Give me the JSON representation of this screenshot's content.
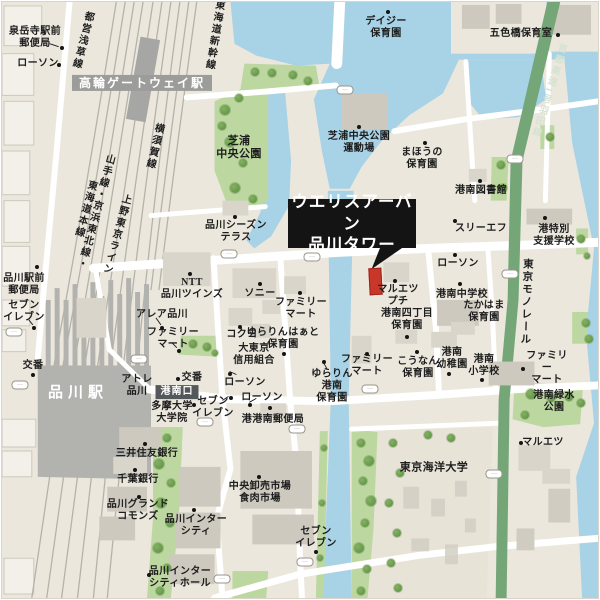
{
  "map": {
    "callout": {
      "line1": "ウエリスアーバン",
      "line2": "品川タワー"
    },
    "colors": {
      "land": "#ebe7dd",
      "water": "#a8d2e6",
      "park": "#bcd79f",
      "tree": "#6fa150",
      "road": "#ffffff",
      "rail": "#b5b2aa",
      "station": "#b2b2af",
      "expressway": "#74a678",
      "building": "#d9d5cb",
      "label": "#1d1d1d",
      "callout_bg": "#141414",
      "highlight_building": "#c8372a",
      "station_badge": "#9c9c9a",
      "exit_badge": "#55585a"
    },
    "labels": [
      {
        "id": "sengakuji-post",
        "text": "泉岳寺駅前\n郵便局",
        "x": 33,
        "y": 36
      },
      {
        "id": "lawson-nw",
        "text": "ローソン",
        "x": 36,
        "y": 62
      },
      {
        "id": "toei-asakusa-line",
        "text": "都営浅草線",
        "x": 79,
        "y": 38,
        "cls": "vert",
        "rotate": 14
      },
      {
        "id": "takanawa-gateway-sta",
        "text": "高輪ゲートウェイ駅",
        "x": 140,
        "y": 81,
        "cls": "badge-gray",
        "size": 12
      },
      {
        "id": "yokosuka-line",
        "text": "横須賀線",
        "x": 151,
        "y": 144,
        "cls": "vert",
        "rotate": 13
      },
      {
        "id": "yamanote-keihin-tokaido-line",
        "text": "山手線・京浜東北線・\n東海道本線",
        "x": 87,
        "y": 208,
        "cls": "vert",
        "rotate": 15
      },
      {
        "id": "ueno-tokyo-line",
        "text": "上野東京ライン",
        "x": 113,
        "y": 232,
        "cls": "vert",
        "rotate": 15
      },
      {
        "id": "tokaido-shinkansen",
        "text": "東海道新幹線",
        "x": 211,
        "y": 33,
        "cls": "vert",
        "rotate": 9
      },
      {
        "id": "daisy-hoikuen",
        "text": "デイジー\n保育園",
        "x": 384,
        "y": 26
      },
      {
        "id": "goshikibashi-hoikushitsu",
        "text": "五色橋保育室",
        "x": 519,
        "y": 32
      },
      {
        "id": "shuto-expressway-haneda",
        "text": "首都高速1号羽田線",
        "x": 545,
        "y": 88,
        "cls": "vert",
        "rotate": 17,
        "size": 9.5,
        "color": "#d6e3d2"
      },
      {
        "id": "shibaura-chuo-park",
        "text": "芝浦\n中央公園",
        "x": 237,
        "y": 146,
        "size": 11
      },
      {
        "id": "shibaura-undojo",
        "text": "芝浦中央公園\n運動場",
        "x": 357,
        "y": 141
      },
      {
        "id": "mahou-hoikuen",
        "text": "まほうの\n保育園",
        "x": 420,
        "y": 157
      },
      {
        "id": "konan-library",
        "text": "港南図書館",
        "x": 479,
        "y": 189
      },
      {
        "id": "shinagawa-season-terrace",
        "text": "品川シーズン\nテラス",
        "x": 234,
        "y": 230
      },
      {
        "id": "three-f",
        "text": "スリーエフ",
        "x": 479,
        "y": 227
      },
      {
        "id": "minato-shien-gakko",
        "text": "港特別\n支援学校",
        "x": 552,
        "y": 234
      },
      {
        "id": "lawson-center",
        "text": "ローソン",
        "x": 456,
        "y": 262
      },
      {
        "id": "tokyo-monorail",
        "text": "東京モノレール",
        "x": 524,
        "y": 300,
        "cls": "vert",
        "rotate": 2,
        "size": 10.5
      },
      {
        "id": "ntt-shinagawa-twins",
        "text": "NTT\n品川ツインズ",
        "x": 190,
        "y": 287
      },
      {
        "id": "sony",
        "text": "ソニー",
        "x": 258,
        "y": 292
      },
      {
        "id": "famima-sony",
        "text": "ファミリー\nマート",
        "x": 299,
        "y": 307
      },
      {
        "id": "alea-shinagawa",
        "text": "アレア品川",
        "x": 160,
        "y": 313
      },
      {
        "id": "famima-alea",
        "text": "ファミリー\nマート",
        "x": 171,
        "y": 337
      },
      {
        "id": "kokuyo",
        "text": "コクヨ",
        "x": 240,
        "y": 333
      },
      {
        "id": "yurarin-heart-hoikuen",
        "text": "ゆらりんはぁと\n保育園",
        "x": 281,
        "y": 337
      },
      {
        "id": "daitokyo-shinyo-kumiai",
        "text": "大東京\n信用組合",
        "x": 252,
        "y": 353
      },
      {
        "id": "lawson-mid",
        "text": "ローソン",
        "x": 243,
        "y": 381
      },
      {
        "id": "koban-center",
        "text": "交番",
        "x": 190,
        "y": 376
      },
      {
        "id": "atre-shinagawa",
        "text": "アトレ\n品川",
        "x": 135,
        "y": 384
      },
      {
        "id": "konan-exit",
        "text": "港南口",
        "x": 175,
        "y": 390,
        "cls": "badge-dark"
      },
      {
        "id": "shinagawa-sta",
        "text": "品川駅",
        "x": 76,
        "y": 392,
        "cls": "station",
        "size": 15
      },
      {
        "id": "koban-left",
        "text": "交番",
        "x": 31,
        "y": 364
      },
      {
        "id": "tama-univ",
        "text": "多摩大学\n大学院",
        "x": 170,
        "y": 411
      },
      {
        "id": "seven-konan-exit",
        "text": "セブン\nイレブン",
        "x": 211,
        "y": 406
      },
      {
        "id": "lawson-post",
        "text": "ローソン",
        "x": 260,
        "y": 396
      },
      {
        "id": "konan-post-office",
        "text": "港港南郵便局",
        "x": 271,
        "y": 418
      },
      {
        "id": "smbc-bank",
        "text": "三井住友銀行",
        "x": 145,
        "y": 452
      },
      {
        "id": "chiba-bank",
        "text": "千葉銀行",
        "x": 136,
        "y": 478
      },
      {
        "id": "shinagawa-grand-commons",
        "text": "品川グランド\nコモンズ",
        "x": 136,
        "y": 509
      },
      {
        "id": "shinagawa-intercity",
        "text": "品川インター\nシティ",
        "x": 194,
        "y": 524
      },
      {
        "id": "shinagawa-intercity-hall",
        "text": "品川インター\nシティホール",
        "x": 178,
        "y": 576
      },
      {
        "id": "chuo-wholesale-market",
        "text": "中央卸売市場\n食肉市場",
        "x": 258,
        "y": 491
      },
      {
        "id": "seven-market",
        "text": "セブン\nイレブン",
        "x": 314,
        "y": 536
      },
      {
        "id": "maruetsu-petit",
        "text": "マルエツ\nプチ",
        "x": 396,
        "y": 294
      },
      {
        "id": "konan-jhs",
        "text": "港南中学校",
        "x": 460,
        "y": 293
      },
      {
        "id": "takahama-hoikuen",
        "text": "たかはま\n保育園",
        "x": 482,
        "y": 310
      },
      {
        "id": "konan-4chome-hoikuen",
        "text": "港南四丁目\n保育園",
        "x": 405,
        "y": 318
      },
      {
        "id": "famima-canal",
        "text": "ファミリー\nマート",
        "x": 365,
        "y": 364
      },
      {
        "id": "kounan-hoikuen",
        "text": "こうなん\n保育園",
        "x": 416,
        "y": 366
      },
      {
        "id": "konan-kindergarten",
        "text": "港南\n幼稚園",
        "x": 450,
        "y": 357
      },
      {
        "id": "konan-elementary",
        "text": "港南\n小学校",
        "x": 482,
        "y": 364
      },
      {
        "id": "yurarin-konan-hoikuen",
        "text": "ゆらりん\n港南\n保育園",
        "x": 330,
        "y": 384
      },
      {
        "id": "famima-east",
        "text": "ファミリー\nマート",
        "x": 545,
        "y": 366
      },
      {
        "id": "konan-ryokusui-park",
        "text": "港南緑水\n公園",
        "x": 552,
        "y": 400
      },
      {
        "id": "maruetsu",
        "text": "マルエツ",
        "x": 541,
        "y": 441
      },
      {
        "id": "tokyo-kaiyo-univ",
        "text": "東京海洋大学",
        "x": 432,
        "y": 466,
        "size": 11
      },
      {
        "id": "shinagawa-ekimae-post",
        "text": "品川駅前\n郵便局",
        "x": 22,
        "y": 283
      },
      {
        "id": "seven-left",
        "text": "セブン\nイレブン",
        "x": 22,
        "y": 310
      }
    ],
    "poi_dots": [
      [
        60,
        46
      ],
      [
        57,
        63
      ],
      [
        386,
        10
      ],
      [
        556,
        33
      ],
      [
        357,
        125
      ],
      [
        423,
        141
      ],
      [
        478,
        179
      ],
      [
        453,
        219
      ],
      [
        543,
        216
      ],
      [
        453,
        253
      ],
      [
        233,
        215
      ],
      [
        188,
        272
      ],
      [
        258,
        282
      ],
      [
        298,
        291
      ],
      [
        160,
        326
      ],
      [
        177,
        349
      ],
      [
        238,
        325
      ],
      [
        282,
        352
      ],
      [
        228,
        372
      ],
      [
        176,
        377
      ],
      [
        35,
        265
      ],
      [
        32,
        326
      ],
      [
        31,
        373
      ],
      [
        192,
        403
      ],
      [
        229,
        396
      ],
      [
        248,
        403
      ],
      [
        268,
        406
      ],
      [
        143,
        442
      ],
      [
        133,
        468
      ],
      [
        137,
        495
      ],
      [
        192,
        508
      ],
      [
        147,
        573
      ],
      [
        257,
        475
      ],
      [
        314,
        550
      ],
      [
        393,
        279
      ],
      [
        458,
        282
      ],
      [
        405,
        335
      ],
      [
        365,
        352
      ],
      [
        415,
        350
      ],
      [
        447,
        372
      ],
      [
        480,
        378
      ],
      [
        322,
        360
      ],
      [
        521,
        367
      ],
      [
        519,
        441
      ]
    ],
    "leader_lines": [
      [
        48,
        42,
        57,
        45
      ],
      [
        27,
        320,
        31,
        325
      ],
      [
        155,
        318,
        160,
        325
      ],
      [
        171,
        343,
        176,
        348
      ],
      [
        236,
        375,
        229,
        372
      ],
      [
        222,
        401,
        228,
        397
      ],
      [
        185,
        407,
        191,
        404
      ],
      [
        327,
        369,
        323,
        362
      ],
      [
        256,
        399,
        249,
        403
      ]
    ],
    "signal_badges": [
      [
        12,
        330
      ],
      [
        18,
        383
      ],
      [
        137,
        357
      ],
      [
        203,
        420
      ],
      [
        295,
        427
      ],
      [
        227,
        252
      ],
      [
        310,
        255
      ],
      [
        343,
        88
      ],
      [
        368,
        387
      ],
      [
        508,
        272
      ],
      [
        513,
        157
      ],
      [
        492,
        472
      ],
      [
        220,
        577
      ],
      [
        303,
        560
      ]
    ]
  }
}
